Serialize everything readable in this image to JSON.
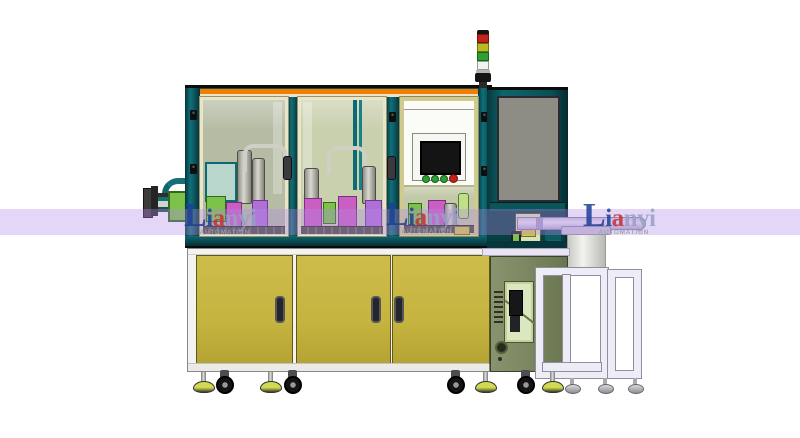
{
  "watermark": {
    "initial": "L",
    "prefix": "i",
    "accent": "a",
    "suffix": "nyi",
    "subtitle": "AUTOMATION"
  },
  "signal_tower": {
    "lamps": [
      "red-lamp-icon",
      "yellow-lamp-icon",
      "green-lamp-icon",
      "white-lamp-icon"
    ]
  },
  "colors": {
    "band": "rgba(178,138,230,0.35)",
    "trim-orange": "#f57e00",
    "frame-teal": "#0b5d62",
    "panel-gray": "#8d8d85",
    "glass1": "#b6bca4",
    "glass2": "#c9d0ae",
    "glass3": "#c2c9a8",
    "window-cream": "#e8e5c8",
    "window-khaki": "#cfcb8e",
    "door-yellow": "#c6b440",
    "cabinet-white": "#f3f3f0",
    "sage": "#7e8a64",
    "stand-white": "#eeedf5",
    "lamp-red": "#c2231a",
    "lamp-yellow": "#b5bd22",
    "lamp-green": "#2f9e33",
    "lamp-white": "#f2f2ee",
    "wm-navy": "#1e3f97",
    "wm-red": "#c53030",
    "wm-light": "#96a1c4",
    "wm-gray": "#9aa0a8"
  }
}
